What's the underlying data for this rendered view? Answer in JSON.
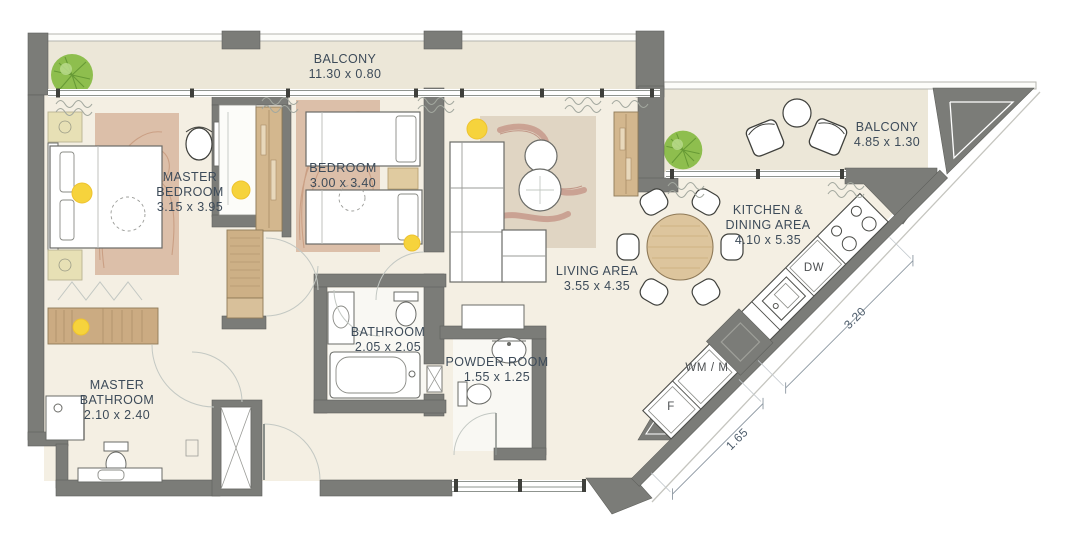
{
  "title": "apartment-floor-plan",
  "colors": {
    "wall": "#7b7c78",
    "floor": "#f4efe3",
    "balcony_floor": "#ece7d8",
    "label_text": "#3d4b59",
    "dim_text": "#4d5c6b",
    "wood": "#cdb086",
    "rug": "#dcbfa9",
    "living_rug": "#e0d5c3",
    "accent_dot": "#f6d33c",
    "plant": "#8ebe4e"
  },
  "rooms": {
    "balcony_top": {
      "label": "BALCONY",
      "dims": "11.30 x 0.80"
    },
    "balcony_right": {
      "label": "BALCONY",
      "dims": "4.85 x 1.30"
    },
    "master_bedroom": {
      "label_line1": "MASTER",
      "label_line2": "BEDROOM",
      "dims": "3.15 x 3.95"
    },
    "bedroom": {
      "label": "BEDROOM",
      "dims": "3.00 x 3.40"
    },
    "living": {
      "label": "LIVING AREA",
      "dims": "3.55 x 4.35"
    },
    "kitchen": {
      "label_line1": "KITCHEN &",
      "label_line2": "DINING AREA",
      "dims": "4.10 x 5.35"
    },
    "bathroom": {
      "label": "BATHROOM",
      "dims": "2.05 x 2.05"
    },
    "powder": {
      "label": "POWDER ROOM",
      "dims": "1.55 x 1.25"
    },
    "master_bath": {
      "label_line1": "MASTER",
      "label_line2": "BATHROOM",
      "dims": "2.10 x 2.40"
    }
  },
  "appliances": {
    "dishwasher": "DW",
    "washer": "WM / M",
    "fridge": "F"
  },
  "dimensions": {
    "kitchen_run": "3.20",
    "utility_run": "1.65"
  }
}
